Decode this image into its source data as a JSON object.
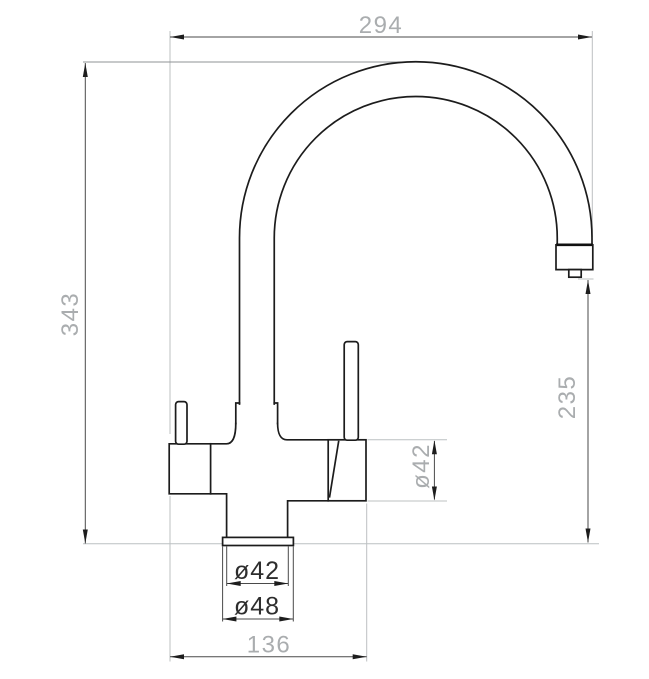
{
  "drawing": {
    "kind": "faucet-technical-dimension-drawing",
    "units": "mm",
    "colors": {
      "outline": "#1c1c1c",
      "dimension_line": "#4a4a4a",
      "extension_line": "#bcc0c2",
      "text_gray": "#aaadaf",
      "text_dark": "#2d2d2d",
      "background": "#ffffff"
    },
    "dimensions": {
      "spout_reach": {
        "label": "294",
        "orientation": "horizontal"
      },
      "total_height": {
        "label": "343",
        "orientation": "vertical"
      },
      "outlet_height": {
        "label": "235",
        "orientation": "vertical"
      },
      "valve_diameter": {
        "label": "ø42",
        "orientation": "vertical"
      },
      "shank_diameter": {
        "label": "ø42",
        "orientation": "horizontal"
      },
      "flange_diameter": {
        "label": "ø48",
        "orientation": "horizontal"
      },
      "base_width": {
        "label": "136",
        "orientation": "horizontal"
      }
    }
  }
}
